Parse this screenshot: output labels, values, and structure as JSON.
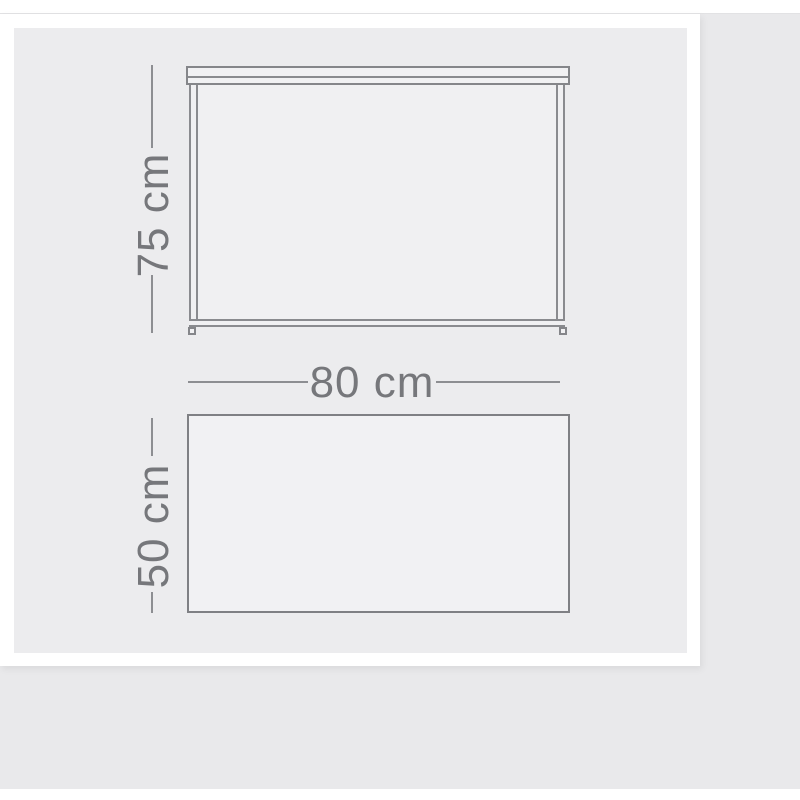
{
  "image": {
    "type": "product-dimension-diagram",
    "subject": "table"
  },
  "labels": {
    "height": "75 cm",
    "width": "80 cm",
    "depth": "50 cm"
  },
  "colors": {
    "page_bg": "#ffffff",
    "photo_bg": "#e9e9eb",
    "card_border": "#ffffff",
    "card_bg": "#ececee",
    "shape_fill": "#f1f1f3",
    "stroke": "#85868a",
    "dimension_line": "#8d8e92",
    "dimension_text": "#76777b"
  }
}
